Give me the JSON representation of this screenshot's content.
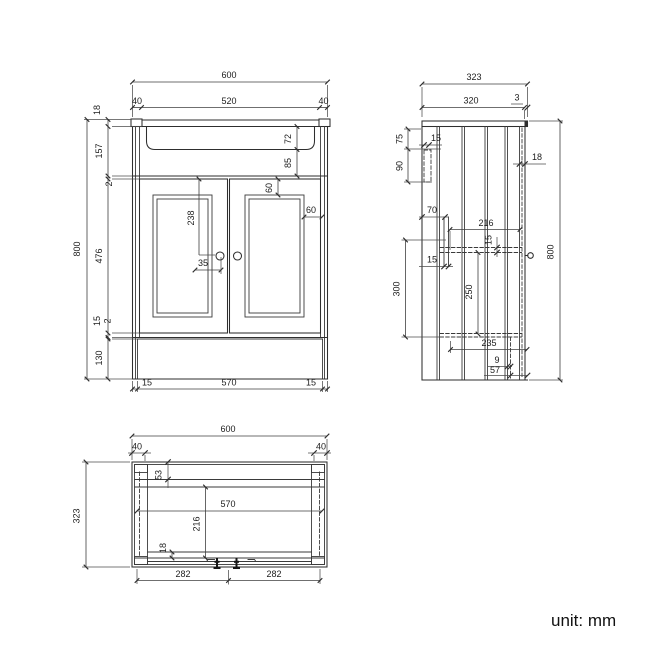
{
  "footer": {
    "unit_label": "unit: mm"
  },
  "views": {
    "front": {
      "dims": {
        "overall_width": "600",
        "side_left": "40",
        "basin_width": "520",
        "side_right": "40",
        "top_thickness": "18",
        "upper_section": "157",
        "top_gap": "2",
        "door_height": "476",
        "bottom_rail": "15",
        "bottom_gap": "2",
        "plinth_height": "130",
        "overall_height": "800",
        "basin_depth": "72",
        "basin_to_doors": "85",
        "panel_inset_top": "60",
        "panel_inset_side": "60",
        "handle_from_top": "238",
        "handle_offset": "35",
        "plinth_inset_left": "15",
        "plinth_width": "570",
        "plinth_inset_right": "15"
      }
    },
    "side": {
      "dims": {
        "overall_depth": "323",
        "top_depth": "320",
        "top_lip": "3",
        "bracket_upper": "75",
        "bracket_lower": "90",
        "back_panel": "15",
        "rail_offset": "70",
        "rail_width": "15",
        "shelf_depth": "216",
        "shelf_thickness": "15",
        "shelf_drop": "300",
        "shelf_to_bottom": "250",
        "bottom_depth": "235",
        "front_gap": "9",
        "plinth_recess": "57",
        "door_thickness": "18",
        "overall_height": "800"
      }
    },
    "plan": {
      "dims": {
        "overall_width": "600",
        "post_left": "40",
        "post_right": "40",
        "overall_depth": "323",
        "back_rail": "53",
        "inner_width": "570",
        "inner_depth": "216",
        "front_rail": "18",
        "hinge_span_left": "282",
        "hinge_span_right": "282"
      }
    }
  }
}
